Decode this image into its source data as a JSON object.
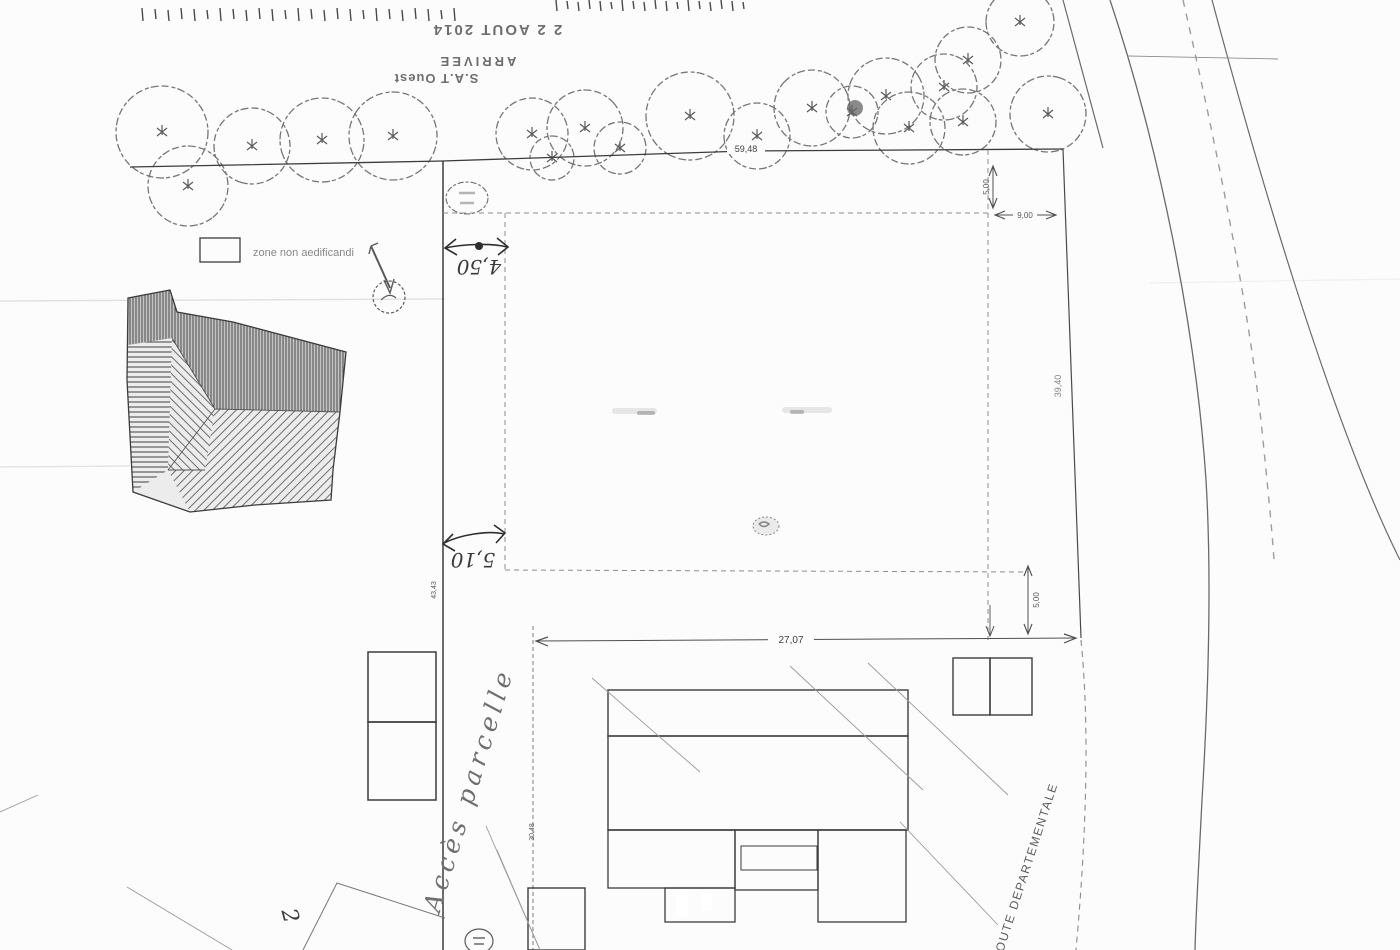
{
  "stamp": {
    "date": "2 2 AOUT 2014",
    "arrivee": "ARRIVEE",
    "service": "S.A.T Ouest"
  },
  "legend": {
    "zone_label": "zone non aedificandi"
  },
  "dimensions": {
    "front_setback": "4,50",
    "mid_setback": "5,10",
    "plot_width": "27,07",
    "ne_vertical": "5,00",
    "ne_horizontal": "9,00",
    "se_vertical": "5,00",
    "left_boundary": "43,43",
    "top_boundary": "59,48",
    "right_boundary": "39,40",
    "access_length": "30,48"
  },
  "labels": {
    "access": "Accès parcelle",
    "road": "ROUTE DEPARTEMENTALE",
    "parcel_number": "2"
  },
  "colors": {
    "paper": "#fcfcfc",
    "ink": "#3c3c3c",
    "light_ink": "#777777",
    "hatch_bg": "#c9c9c9"
  },
  "geometry": {
    "trees": [
      [
        162,
        132,
        46
      ],
      [
        188,
        186,
        40
      ],
      [
        252,
        146,
        38
      ],
      [
        322,
        140,
        42
      ],
      [
        393,
        136,
        44
      ],
      [
        532,
        134,
        36
      ],
      [
        585,
        128,
        38
      ],
      [
        552,
        158,
        22
      ],
      [
        620,
        148,
        26
      ],
      [
        690,
        116,
        44
      ],
      [
        757,
        136,
        33
      ],
      [
        812,
        108,
        38
      ],
      [
        852,
        112,
        26
      ],
      [
        886,
        96,
        38
      ],
      [
        909,
        128,
        36
      ],
      [
        944,
        87,
        33
      ],
      [
        968,
        60,
        33
      ],
      [
        1020,
        22,
        34
      ],
      [
        963,
        122,
        33
      ],
      [
        1048,
        114,
        38
      ]
    ],
    "tree_blob": {
      "cx": 855,
      "cy": 108,
      "r": 8
    },
    "tick_rows": [
      {
        "x0": 142,
        "y": 8,
        "h": 13,
        "step": 13,
        "count": 25
      },
      {
        "x0": 556,
        "y": 0,
        "h": 11,
        "step": 11,
        "count": 18
      }
    ],
    "diagonal_lines": [
      [
        592,
        678,
        700,
        772
      ],
      [
        790,
        666,
        923,
        790
      ],
      [
        868,
        663,
        1008,
        795
      ],
      [
        900,
        822,
        998,
        925
      ],
      [
        486,
        826,
        540,
        950
      ],
      [
        497,
        850,
        540,
        950
      ],
      [
        127,
        887,
        232,
        950
      ],
      [
        0,
        812,
        38,
        795
      ]
    ],
    "zigzag": "303,950 337,883 445,918"
  }
}
